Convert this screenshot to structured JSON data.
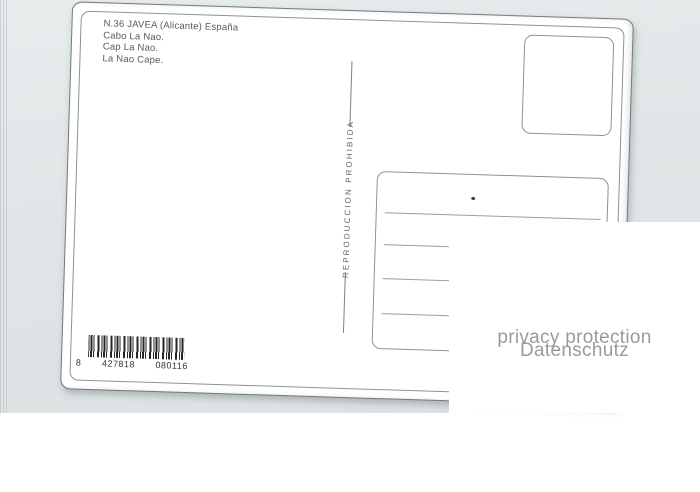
{
  "postcard": {
    "header_lines": [
      "N.36 JAVEA (Alicante) España",
      "Cabo La Nao.",
      "Cap La Nao.",
      "La Nao Cape."
    ],
    "divider_label": "REPRODUCCION PROHIBIDA",
    "barcode": {
      "lead_digit": "8",
      "group1": "427818",
      "group2": "080116",
      "full_value": "8 427818 080116"
    }
  },
  "privacy_overlay": {
    "line1": "privacy protection",
    "line2": "Datenschutz"
  },
  "colors": {
    "scan_background": "#e0e6e7",
    "card": "#ffffff",
    "card_edge": "#74797b",
    "frame_line": "#8d9293",
    "ink": "#55585a",
    "address_line": "#9aa0a1",
    "barcode_ink": "#262626",
    "privacy_text": "#9a9a9a"
  }
}
